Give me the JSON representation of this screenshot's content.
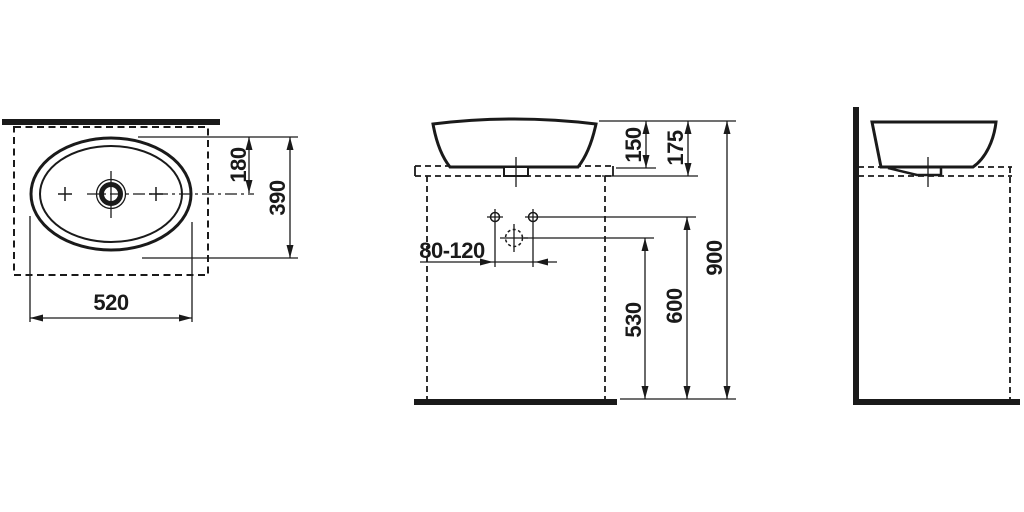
{
  "drawing": {
    "background_color": "#ffffff",
    "line_color": "#1a1a1a",
    "top_view": {
      "width": "520",
      "depth": "390",
      "drain_center_from_rear": "180"
    },
    "front_view": {
      "basin_height": "150",
      "rim_above_counter": "175",
      "rim_height_from_floor": "900",
      "supply_height_from_floor": "600",
      "drain_height_from_floor": "530",
      "fitting_offset_range": "80-120"
    }
  }
}
